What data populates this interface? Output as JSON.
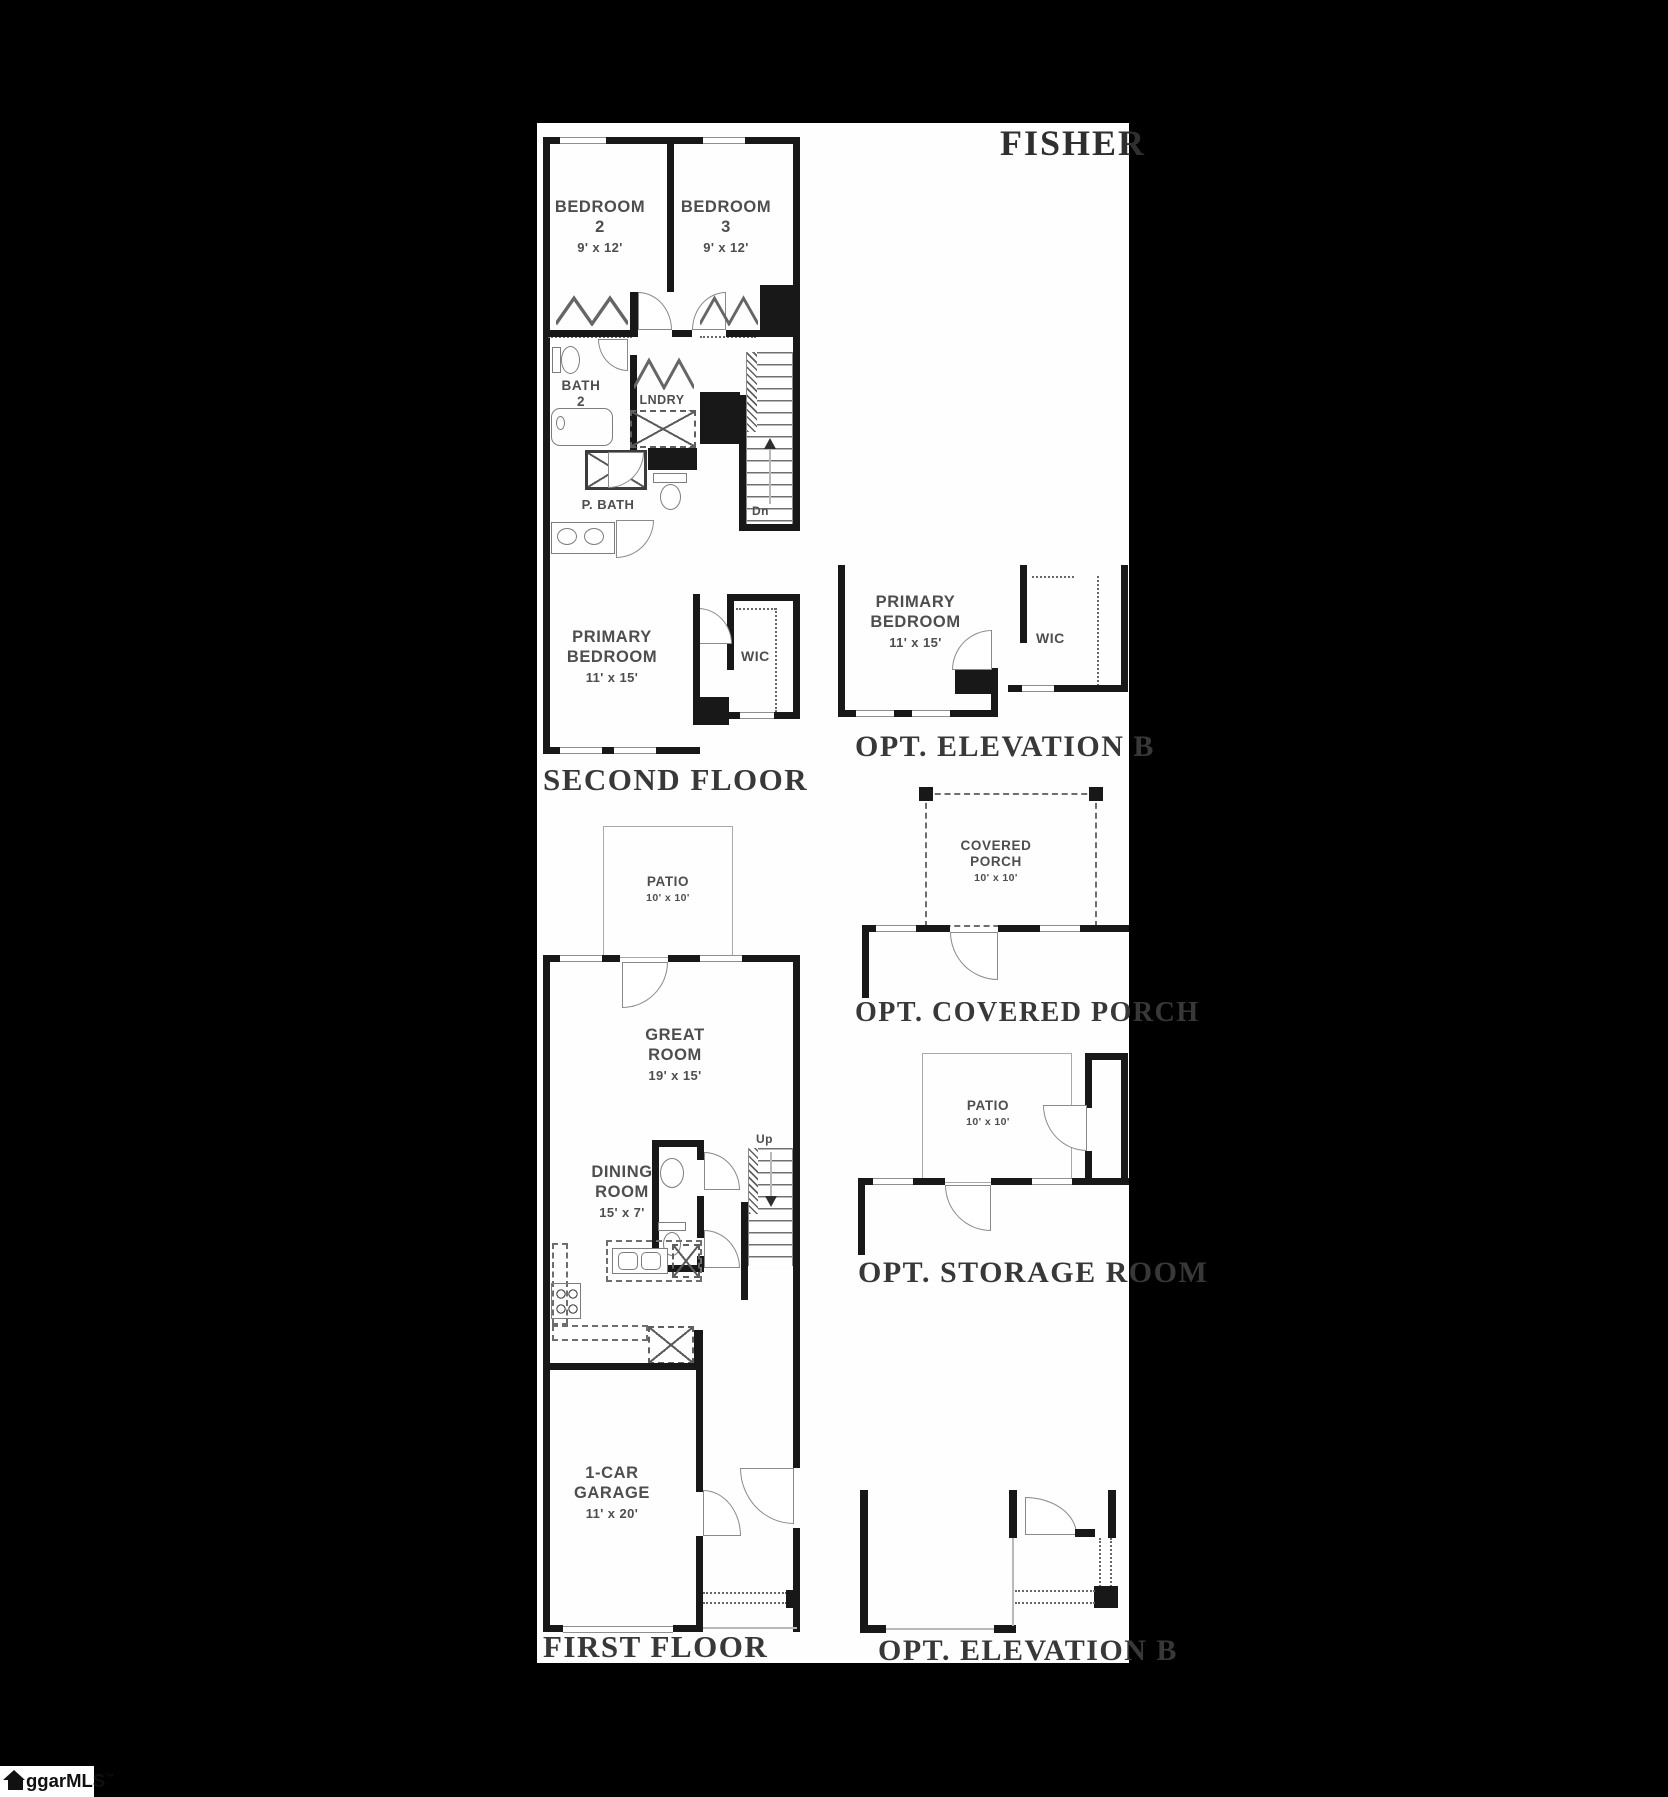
{
  "plan_title": "FISHER",
  "logo": {
    "icon": "house",
    "text": "ggarMLS",
    "tm": "™"
  },
  "second_floor": {
    "title": "SECOND FLOOR",
    "bedroom2_name": "BEDROOM 2",
    "bedroom2_dims": "9' x 12'",
    "bedroom3_name": "BEDROOM 3",
    "bedroom3_dims": "9' x 12'",
    "bath2_name": "BATH 2",
    "laundry_name": "LNDRY",
    "primary_bath_name": "P. BATH",
    "primary_bedroom_name": "PRIMARY BEDROOM",
    "primary_bedroom_dims": "11' x 15'",
    "wic_name": "WIC",
    "stairs_label": "Dn"
  },
  "first_floor": {
    "title": "FIRST FLOOR",
    "patio_name": "PATIO",
    "patio_dims": "10' x 10'",
    "great_room_name": "GREAT ROOM",
    "great_room_dims": "19' x 15'",
    "dining_room_name": "DINING ROOM",
    "dining_room_dims": "15' x 7'",
    "garage_name": "1-CAR GARAGE",
    "garage_dims": "11' x 20'",
    "stairs_label": "Up"
  },
  "opt_elevation_b_second": {
    "title": "OPT. ELEVATION B",
    "primary_bedroom_name": "PRIMARY BEDROOM",
    "primary_bedroom_dims": "11' x 15'",
    "wic_name": "WIC"
  },
  "opt_covered_porch": {
    "title": "OPT. COVERED PORCH",
    "porch_name": "COVERED PORCH",
    "porch_dims": "10' x 10'"
  },
  "opt_storage_room": {
    "title": "OPT. STORAGE ROOM",
    "patio_name": "PATIO",
    "patio_dims": "10' x 10'"
  },
  "opt_elevation_b_first": {
    "title": "OPT. ELEVATION B"
  },
  "colors": {
    "background": "#000000",
    "paper": "#ffffff",
    "wall": "#181818",
    "label": "#4e4e4e",
    "title": "#383838"
  }
}
